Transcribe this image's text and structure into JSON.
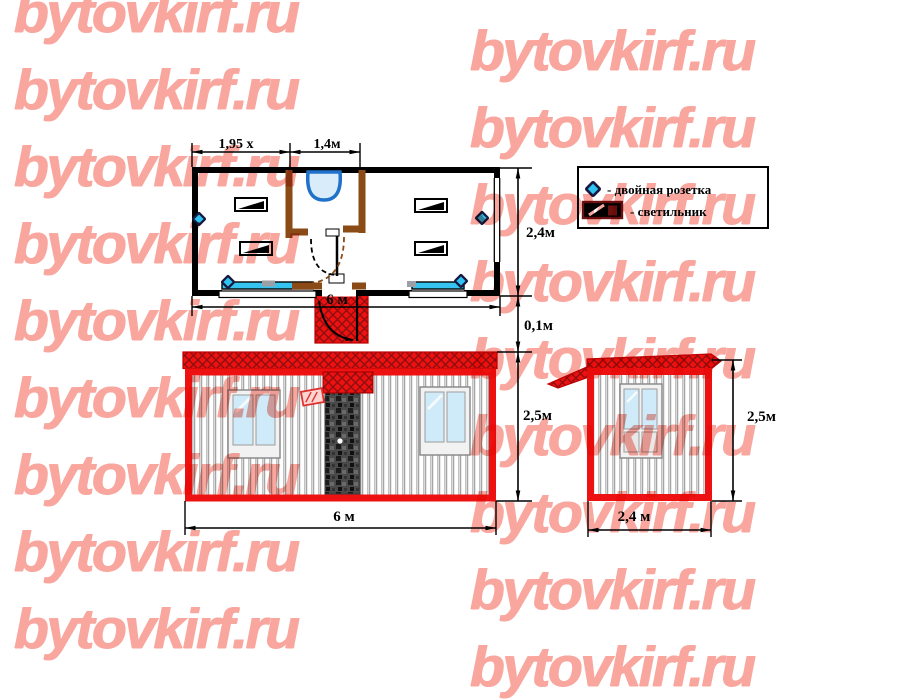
{
  "watermark": {
    "text": "bytovkirf.ru",
    "color": "#f9a79e"
  },
  "legend": {
    "items": [
      {
        "icon": "double-socket-icon",
        "label": "- двойная розетка"
      },
      {
        "icon": "light-fixture-icon",
        "label": "- светильник"
      }
    ]
  },
  "floor_plan": {
    "dim_room_width": "1,95 х",
    "dim_entry_width": "1,4м",
    "dim_depth": "2,4м",
    "dim_total_width": "6 м",
    "dim_gap": "0,1м"
  },
  "front_elevation": {
    "dim_height": "2,5м",
    "dim_width": "6 м"
  },
  "side_elevation": {
    "dim_height": "2,5м",
    "dim_width": "2,4 м"
  },
  "colors": {
    "accent_red": "#ee1111",
    "hatch_dark_red": "#8d0f0f",
    "partition_brown": "#8a4b16",
    "socket_cyan": "#2fc3f2",
    "glass_blue": "#cfeaf8",
    "watermark_pink": "#f9a79e"
  }
}
